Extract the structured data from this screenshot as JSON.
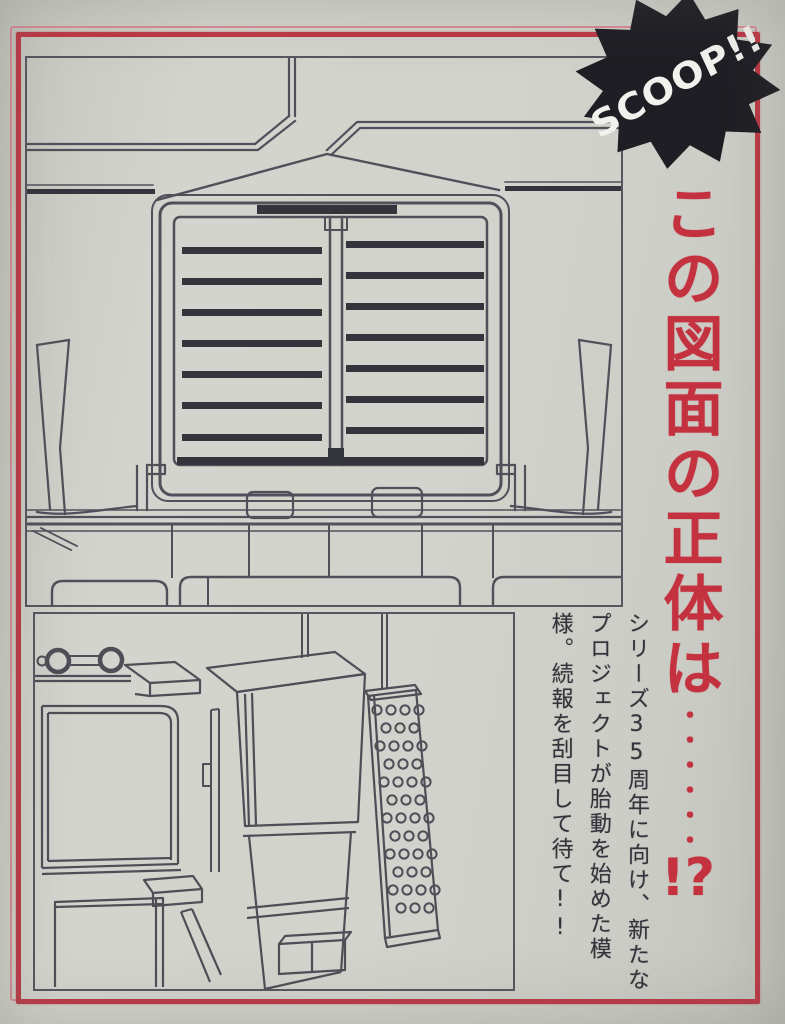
{
  "badge": {
    "label": "SCOOP!!"
  },
  "headline": {
    "main": "この図面の正体は",
    "dots": "・・・・・・",
    "end": "!?"
  },
  "caption": {
    "lines": [
      "シリーズ35周年に向け、新たな",
      "プロジェクトが胎動を始めた模",
      "様。続報を刮目して待て!!"
    ]
  },
  "colors": {
    "frame_red": "#bd3946",
    "frame_pink": "#d98b94",
    "headline_red": "#c43240",
    "badge_black": "#1f1e24",
    "paper": "#d0d1ca",
    "line_ink": "#50505a"
  }
}
